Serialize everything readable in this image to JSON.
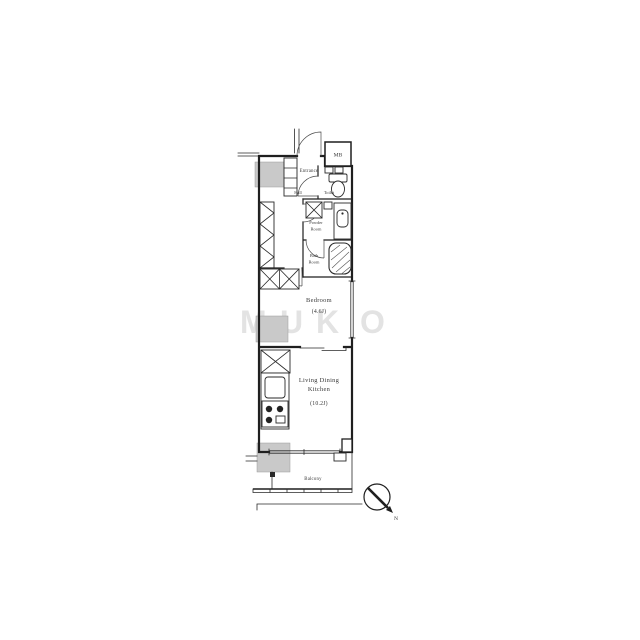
{
  "plan": {
    "labels": {
      "entrance": "Entrance",
      "hall": "Hall",
      "toilet": "Toilet",
      "powder_line1": "Powder",
      "powder_line2": "Room",
      "bath_line1": "Bath",
      "bath_line2": "Room",
      "bedroom": "Bedroom",
      "bedroom_size": "(4.6J)",
      "ldk_line1": "Living Dining",
      "ldk_line2": "Kitchen",
      "ldk_size": "(10.2J)",
      "balcony": "Balcony",
      "meter_box": "MB",
      "compass_north": "N"
    },
    "watermark": {
      "letters": [
        "M",
        "U",
        "K",
        "O"
      ]
    },
    "colors": {
      "wall": "#1f1f1f",
      "neighbor_block_fill": "#c9c9c9",
      "label_text": "#3a3a3a",
      "watermark": "#dadada",
      "background": "#ffffff"
    }
  }
}
